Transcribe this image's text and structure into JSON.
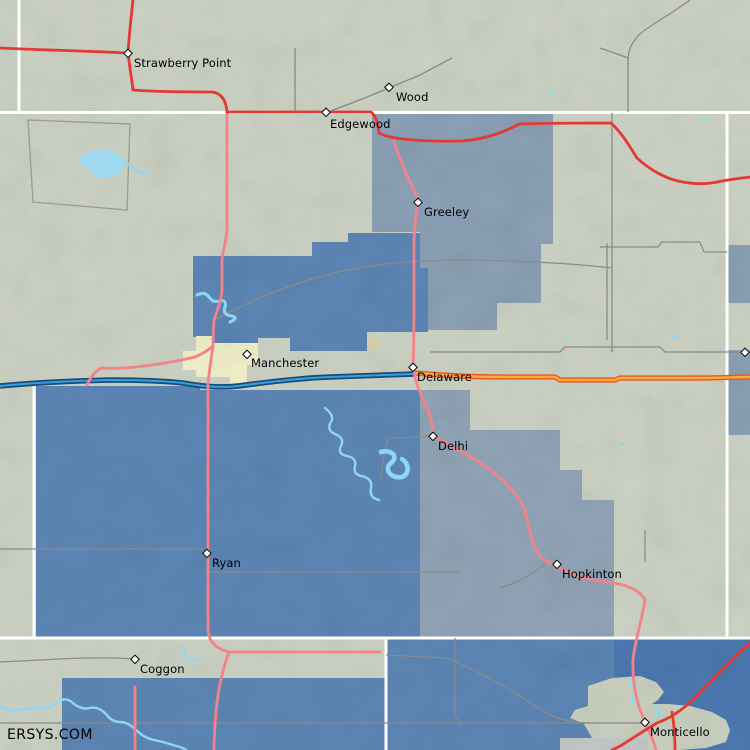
{
  "map": {
    "attribution": "ERSYS.COM",
    "towns": [
      {
        "name": "Strawberry Point"
      },
      {
        "name": "Wood"
      },
      {
        "name": "Edgewood"
      },
      {
        "name": "Greeley"
      },
      {
        "name": "Manchester"
      },
      {
        "name": "Delaware"
      },
      {
        "name": "Delhi"
      },
      {
        "name": "Ryan"
      },
      {
        "name": "Hopkinton"
      },
      {
        "name": "Coggon"
      },
      {
        "name": "Monticello"
      }
    ],
    "colors": {
      "terrain": "#cbd1c3",
      "region_slate": "#8ba0b5",
      "region_blue": "#5c86b5",
      "region_blue_deep": "#4b78b0",
      "urban_cream": "#f1eec9",
      "urban_tan": "#d9d0ad",
      "urban_gray_green": "#c9cfbe",
      "urban_light_gray": "#c3c8c6",
      "water": "#8ed7f2",
      "county_line": "#ffffff",
      "road_minor_gray": "#8a8a8a",
      "road_us_red": "#e63832",
      "road_state_pink": "#f4828a",
      "road_orange_core": "#ffaa33",
      "road_orange_casing": "#e2572e",
      "road_blue_casing": "#1d4a73",
      "road_blue_core": "#30a2e4",
      "label_color": "#000000"
    }
  }
}
